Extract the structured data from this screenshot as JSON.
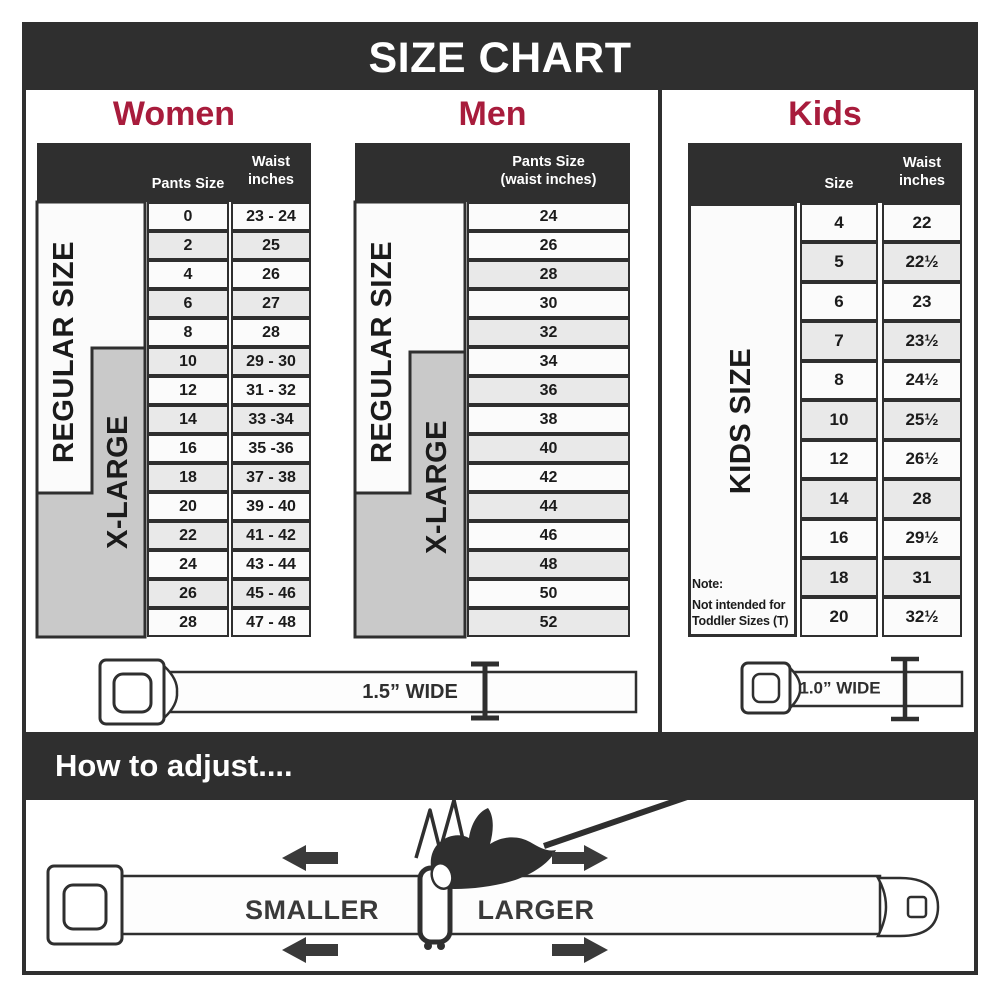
{
  "title": "SIZE CHART",
  "colors": {
    "dark": "#2f2f2f",
    "accent": "#a81c3c",
    "row_light": "#fbfbfb",
    "row_alt": "#e9e9e9",
    "xlarge_gray": "#c9c9c9"
  },
  "sections": {
    "women": {
      "heading": "Women",
      "header": {
        "size_col": "Pants Size",
        "waist_col_line1": "Waist",
        "waist_col_line2": "inches"
      },
      "regular_label": "REGULAR SIZE",
      "xlarge_label": "X-LARGE",
      "rows": [
        {
          "size": "0",
          "waist": "23 - 24"
        },
        {
          "size": "2",
          "waist": "25"
        },
        {
          "size": "4",
          "waist": "26"
        },
        {
          "size": "6",
          "waist": "27"
        },
        {
          "size": "8",
          "waist": "28"
        },
        {
          "size": "10",
          "waist": "29 - 30"
        },
        {
          "size": "12",
          "waist": "31 - 32"
        },
        {
          "size": "14",
          "waist": "33 -34"
        },
        {
          "size": "16",
          "waist": "35 -36"
        },
        {
          "size": "18",
          "waist": "37 - 38"
        },
        {
          "size": "20",
          "waist": "39 - 40"
        },
        {
          "size": "22",
          "waist": "41 - 42"
        },
        {
          "size": "24",
          "waist": "43 - 44"
        },
        {
          "size": "26",
          "waist": "45 - 46"
        },
        {
          "size": "28",
          "waist": "47 - 48"
        }
      ]
    },
    "men": {
      "heading": "Men",
      "header": {
        "col_line1": "Pants Size",
        "col_line2": "(waist inches)"
      },
      "regular_label": "REGULAR SIZE",
      "xlarge_label": "X-LARGE",
      "rows": [
        "24",
        "26",
        "28",
        "30",
        "32",
        "34",
        "36",
        "38",
        "40",
        "42",
        "44",
        "46",
        "48",
        "50",
        "52"
      ]
    },
    "kids": {
      "heading": "Kids",
      "header": {
        "size_col": "Size",
        "waist_col_line1": "Waist",
        "waist_col_line2": "inches"
      },
      "side_label": "KIDS SIZE",
      "note": {
        "line1": "Note:",
        "line2": "Not intended for",
        "line3": "Toddler Sizes (T)"
      },
      "rows": [
        {
          "size": "4",
          "waist": "22"
        },
        {
          "size": "5",
          "waist": "22½"
        },
        {
          "size": "6",
          "waist": "23"
        },
        {
          "size": "7",
          "waist": "23½"
        },
        {
          "size": "8",
          "waist": "24½"
        },
        {
          "size": "10",
          "waist": "25½"
        },
        {
          "size": "12",
          "waist": "26½"
        },
        {
          "size": "14",
          "waist": "28"
        },
        {
          "size": "16",
          "waist": "29½"
        },
        {
          "size": "18",
          "waist": "31"
        },
        {
          "size": "20",
          "waist": "32½"
        }
      ]
    }
  },
  "belts": {
    "adult_label": "1.5” WIDE",
    "kids_label": "1.0” WIDE"
  },
  "adjust": {
    "heading": "How to adjust....",
    "smaller": "SMALLER",
    "larger": "LARGER"
  }
}
